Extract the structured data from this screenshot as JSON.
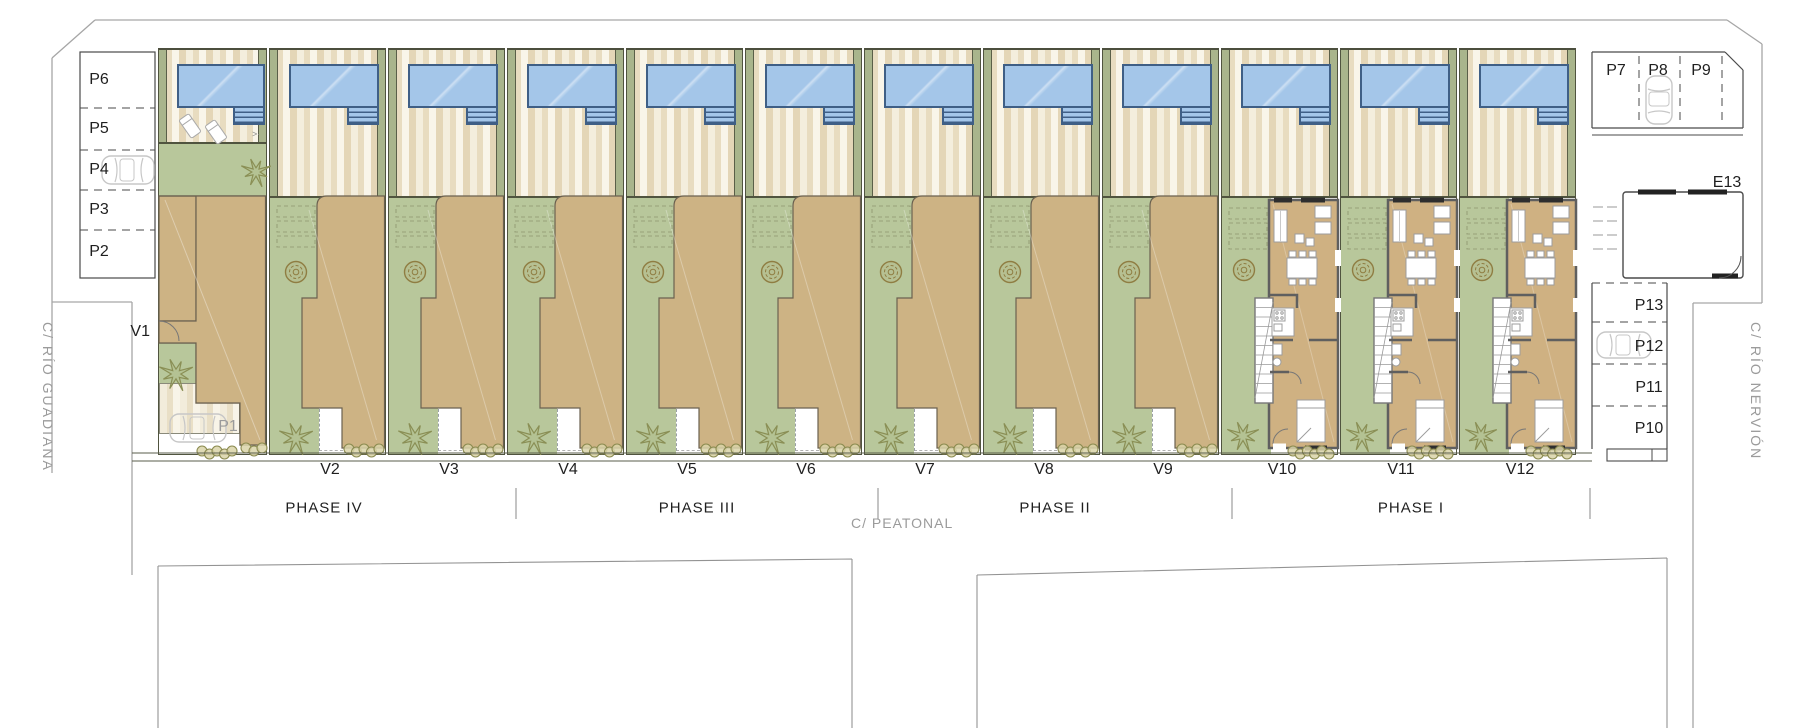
{
  "plan_name": "residential-site-plan",
  "streets": {
    "left": "C/ RÍO GUADIANA",
    "right": "C/ RÍO NERVIÓN",
    "pedestrian": "C/ PEATONAL"
  },
  "phases": [
    "PHASE IV",
    "PHASE III",
    "PHASE II",
    "PHASE I"
  ],
  "villas": [
    "V1",
    "V2",
    "V3",
    "V4",
    "V5",
    "V6",
    "V7",
    "V8",
    "V9",
    "V10",
    "V11",
    "V12"
  ],
  "parking": {
    "left_column": [
      "P6",
      "P5",
      "P4",
      "P3",
      "P2"
    ],
    "top_right_row": [
      "P7",
      "P8",
      "P9"
    ],
    "right_column": [
      "P13",
      "P12",
      "P11",
      "P10"
    ],
    "carport": "P1",
    "utility_room": "E13",
    "spaces_with_car": [
      "P4",
      "P8",
      "P12",
      "P1"
    ]
  },
  "colors": {
    "pool": "#a4c6e9",
    "pool_border": "#3f5f86",
    "lawn": "#b8c79b",
    "roof_tan": "#cdb384",
    "deck_light": "#f9f5e9",
    "deck_dark": "#e4d6b7",
    "wall": "#4c4f3e",
    "label": "#1f1f1f",
    "street_label": "#9b9b9b",
    "hedge": "#8b8b50"
  }
}
